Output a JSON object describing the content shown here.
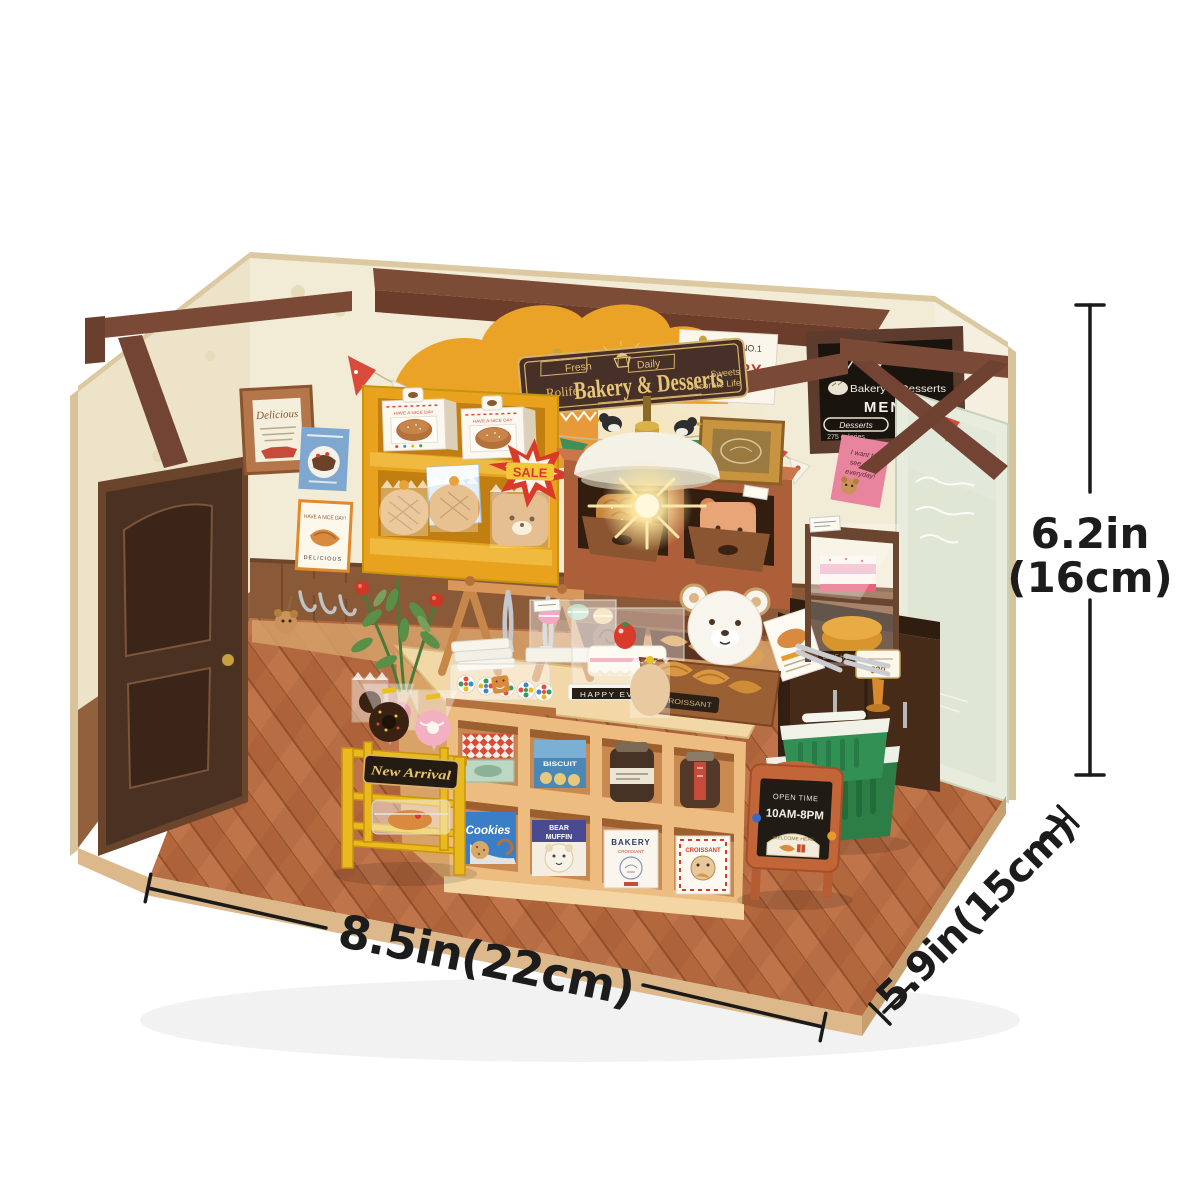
{
  "dimensions": {
    "width_label": "8.5in(22cm)",
    "depth_label": "5.9in(15cm)",
    "height_label_line1": "6.2in",
    "height_label_line2": "(16cm)"
  },
  "sign": {
    "brand": "Rolife",
    "title": "Bakery & Desserts",
    "ribbon_left": "Fresh",
    "ribbon_right": "Daily",
    "tagline_line1": "Sweets",
    "tagline_line2": "Decorate Life"
  },
  "wall_poster_no1": {
    "word_the": "THE",
    "word_no1": "NO.1",
    "word_bakery": "BAKERY"
  },
  "menu_board": {
    "header": "Bakery & Desserts",
    "title": "MENU",
    "pill_label": "Desserts",
    "calories_note": "275 calories"
  },
  "frame_delicious": {
    "title": "Delicious"
  },
  "poster_nice_day": {
    "arc_text": "HAVE A NICE DAY!",
    "bottom_text": "DELICIOUS"
  },
  "pink_note": {
    "line1": "I want to",
    "line2": "see you",
    "line3": "everyday!"
  },
  "bakery_shelf": {
    "bread_box_text": "HAVE A NICE DAY",
    "fresh_label": "FRESH",
    "salt_label": "SALT",
    "sale_label": "SALE"
  },
  "counter_items": {
    "cake_base_label": "HAPPY EVERYDAY",
    "croissant_crate_label": "CROISSANT"
  },
  "cubby_boxes": {
    "biscuit": "BISCUIT",
    "cookies": "Cookies",
    "bear": "BEAR",
    "muffin": "MUFFIN",
    "bakery": "BAKERY",
    "bakery_sub": "CROISSANT",
    "croissant": "CROISSANT"
  },
  "new_arrival_cart": {
    "plaque": "New Arrival"
  },
  "open_sign": {
    "line1": "OPEN TIME",
    "line2": "10AM-8PM",
    "arch_label": "WELCOME HERE"
  },
  "display_case": {
    "shelf_label": "BAKE HOUSE",
    "price_tag": "$20"
  },
  "colors": {
    "accent_red": "#d93a2a",
    "wood_brown": "#7b4a37",
    "sign_brown": "#463028",
    "gold": "#e2bd74",
    "shelf_yellow": "#e8a21e",
    "floor_orange": "#b3673c",
    "basket_green": "#2c7e46",
    "frame_orange": "#c2663a"
  }
}
